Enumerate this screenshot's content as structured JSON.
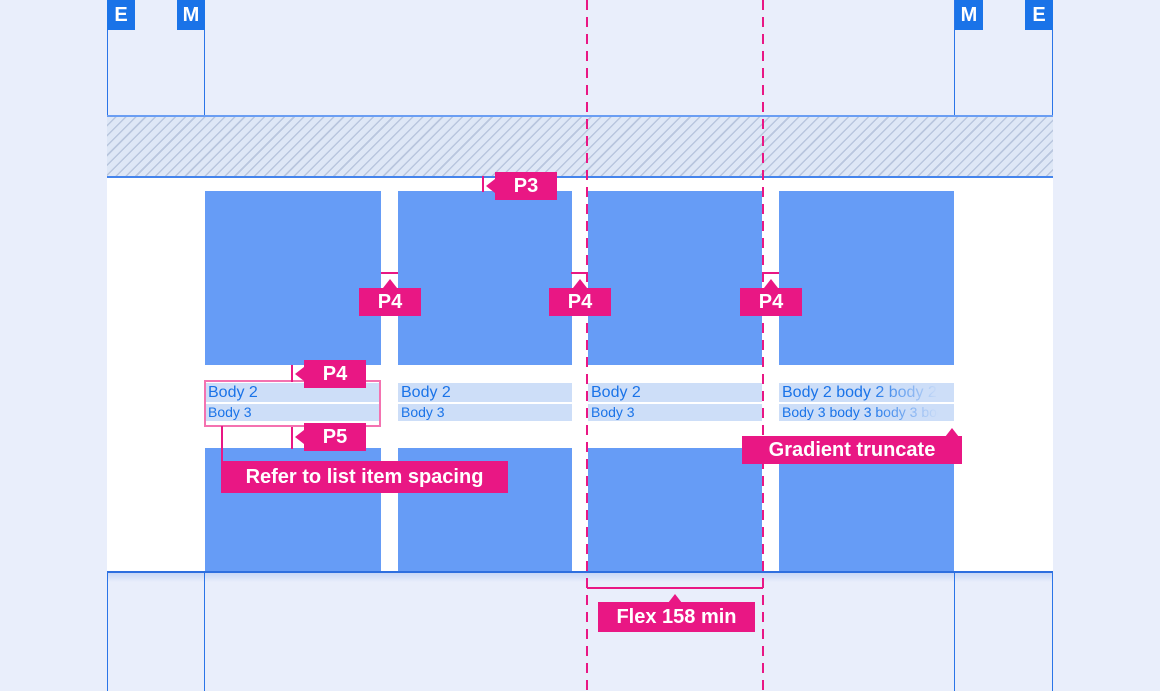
{
  "colors": {
    "background": "#E9EEFB",
    "card_blue": "#669CF6",
    "keyline_blue": "#2A74E8",
    "marker_blue": "#1A73E8",
    "annotation_magenta": "#E91784",
    "text_band": "#CDDEF8",
    "body_text_blue": "#1A73E8",
    "outline_pink": "#F472B0"
  },
  "margin_markers": {
    "top_left": [
      {
        "label": "E"
      },
      {
        "label": "M"
      }
    ],
    "top_right": [
      {
        "label": "M"
      },
      {
        "label": "E"
      }
    ]
  },
  "spacing": {
    "p3": "P3",
    "p4": "P4",
    "p5": "P5"
  },
  "notes": {
    "list_item": "Refer to list item spacing",
    "gradient": "Gradient truncate",
    "flex": "Flex 158 min"
  },
  "cards": [
    {
      "body2": "Body 2",
      "body3": "Body 3"
    },
    {
      "body2": "Body 2",
      "body3": "Body 3"
    },
    {
      "body2": "Body 2",
      "body3": "Body 3"
    },
    {
      "body2": "Body 2 body 2 body 2 body 2",
      "body3": "Body 3 body 3 body 3 body 3"
    }
  ]
}
